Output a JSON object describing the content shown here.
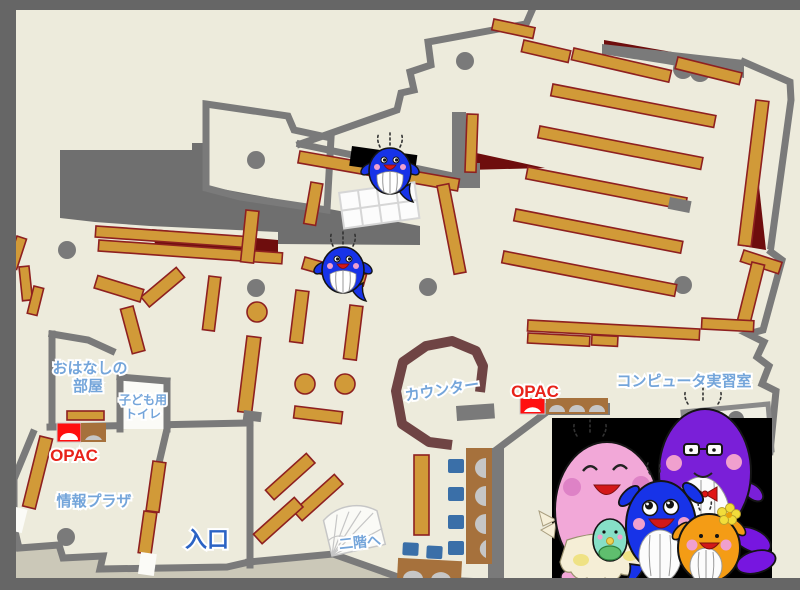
{
  "map": {
    "labels": {
      "storytelling_room_line1": "おはなしの",
      "storytelling_room_line2": "部屋",
      "kids_toilet_line1": "子ども用",
      "kids_toilet_line2": "トイレ",
      "opac_left": "OPAC",
      "opac_right": "OPAC",
      "info_plaza": "情報プラザ",
      "entrance": "入口",
      "counter": "カウンター",
      "computer_room": "コンピュータ実習室",
      "to_second_floor": "二階へ"
    },
    "colors": {
      "floor": "#EDEBDC",
      "outer_border": "#666666",
      "outside_band": "#CBC8B8",
      "wall_gray": "#7A7A7A",
      "void_gray": "#6F6F6F",
      "shelf_tan": "#D19A38",
      "shelf_border_red": "#8E2020",
      "accent_dark_red": "#6E0D0D",
      "counter_brown": "#6F4444",
      "desk_wood": "#A6713C",
      "chair_blue": "#3A6FA8",
      "seat_gray": "#C6C6C6",
      "opac_desk_red": "#FF0F0F",
      "label_blue": "#74A5DA",
      "entrance_blue": "#2B63C4",
      "opac_text_red": "#E8231A",
      "whale_blue": "#1733E8",
      "mascot_pink": "#F2A8D8",
      "mascot_purple": "#7A1FD8",
      "mascot_orange": "#F49C15",
      "mascot_teal": "#86DFC7",
      "mascot_panel_bg": "#000000"
    },
    "mascots": {
      "on_map": [
        "blue-whale-upper",
        "blue-whale-lower"
      ],
      "family_panel": [
        "pink-mother-whale",
        "baby-teal-whale",
        "blue-child-whale",
        "purple-father-whale",
        "orange-whale"
      ]
    }
  }
}
